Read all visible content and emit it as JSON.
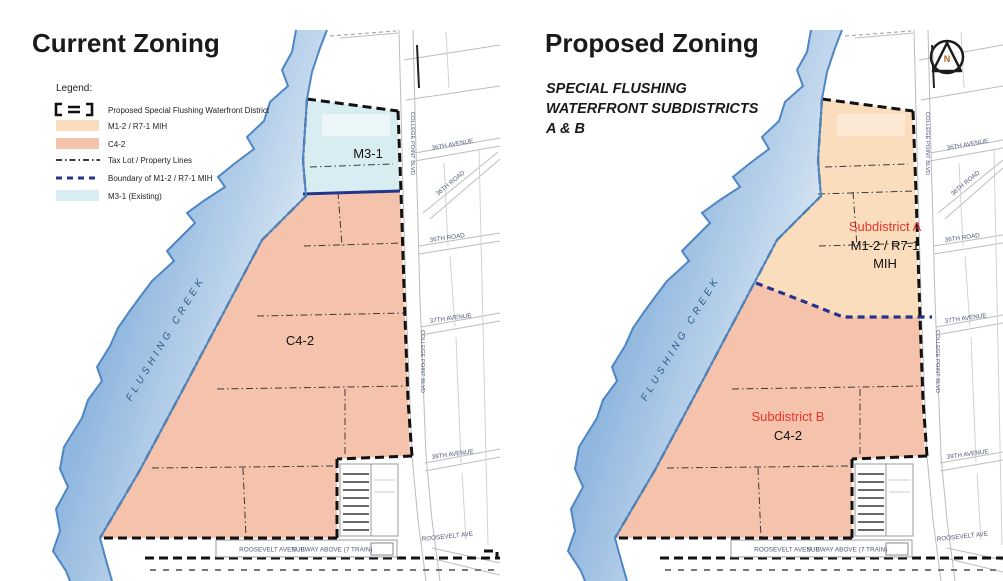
{
  "window": {
    "width": 1003,
    "height": 581
  },
  "colors": {
    "m12_peach": "#FADDBD",
    "c42_salmon": "#F5C3AC",
    "m31_blue": "#D8EDF2",
    "creek_edge": "#4E86C4",
    "navy": "#26338B",
    "red_label": "#E8352C",
    "street_text": "#4F5A78",
    "creek_text": "#2A5C8A"
  },
  "left_panel": {
    "title": "Current Zoning",
    "legend": {
      "heading": "Legend:",
      "items": [
        {
          "label": "Proposed Special Flushing Waterfront District",
          "symbol": "dashed-bracket"
        },
        {
          "label": "M1-2 / R7-1 MIH",
          "symbol": "peach-swatch"
        },
        {
          "label": "C4-2",
          "symbol": "salmon-swatch"
        },
        {
          "label": "Tax Lot / Property Lines",
          "symbol": "dash-dot-line"
        },
        {
          "label": "Boundary of M1-2 / R7-1 MIH",
          "symbol": "blue-dashed-line"
        },
        {
          "label": "M3-1 (Existing)",
          "symbol": "lightblue-swatch"
        }
      ]
    },
    "map": {
      "creek_label": "FLUSHING CREEK",
      "m31_label": "M3-1",
      "c42_label": "C4-2"
    }
  },
  "right_panel": {
    "title": "Proposed Zoning",
    "subtitle_line1": "SPECIAL FLUSHING",
    "subtitle_line2": "WATERFRONT SUBDISTRICTS",
    "subtitle_line3": "A & B",
    "north_label": "N",
    "map": {
      "creek_label": "FLUSHING CREEK",
      "subdistrict_a_name": "Subdistrict A",
      "subdistrict_a_zone": "M1-2 / R7-1",
      "subdistrict_a_zone2": "MIH",
      "subdistrict_b_name": "Subdistrict B",
      "subdistrict_b_zone": "C4-2"
    }
  },
  "streets": {
    "ave36": "36TH AVENUE",
    "rd36_diag": "36TH ROAD",
    "rd36": "36TH ROAD",
    "ave37": "37TH AVENUE",
    "ave39": "39TH AVENUE",
    "college_point": "COLLEGE POINT BLVD",
    "roosevelt": "ROOSEVELT AVE",
    "roosevelt_full": "ROOSEVELT AVENUE",
    "subway": "SUBWAY ABOVE (7 TRAIN)"
  }
}
